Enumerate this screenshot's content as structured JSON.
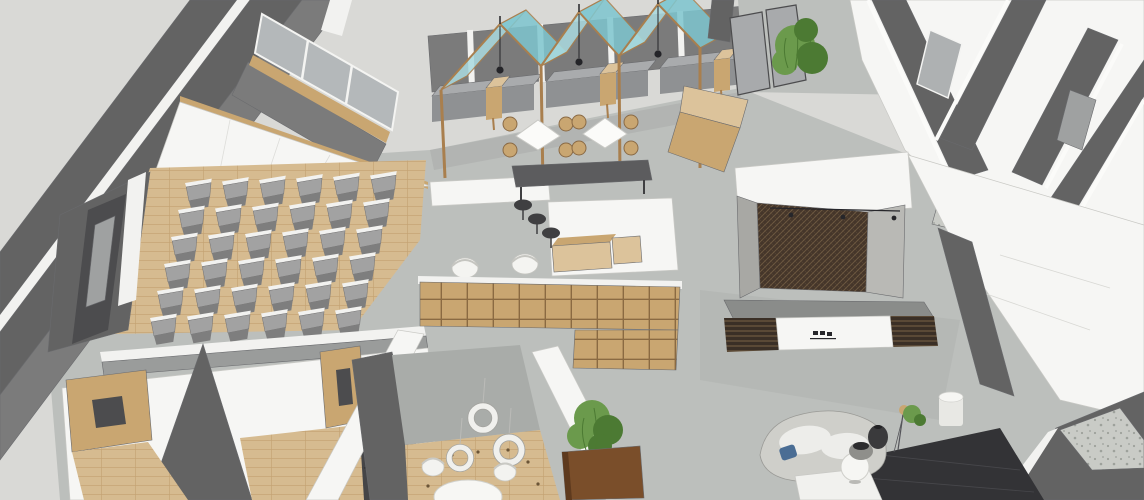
{
  "scene": {
    "type": "3d-interior-render",
    "description": "axonometric sketchup-style rendering of an open-plan office interior",
    "rooms": [
      {
        "id": "auditorium",
        "label": "auditorium-seating-room"
      },
      {
        "id": "cafe-booths",
        "label": "cafe-booth-seating-with-glass-canopies"
      },
      {
        "id": "library",
        "label": "library-bookshelf-room"
      },
      {
        "id": "meeting-room",
        "label": "small-meeting-room"
      },
      {
        "id": "reception",
        "label": "reception-with-mesh-feature-wall"
      },
      {
        "id": "lounge",
        "label": "lounge-seating-area"
      },
      {
        "id": "pantry",
        "label": "pantry-counter"
      },
      {
        "id": "offices",
        "label": "perimeter-offices-and-corridors"
      }
    ],
    "counts": {
      "canopy_modules": 3,
      "pendant_lights": 3,
      "ring_pendants": 3,
      "cafe_diamond_tables": 2,
      "rattan_chairs": 8,
      "bar_stools": 3,
      "booth_benches": 6,
      "booth_side_tables": 3,
      "plants": 3,
      "library_armchairs": 2,
      "meeting_chairs": 2
    }
  },
  "generator": {
    "auditorium_chairs": {
      "rows": 6,
      "cols": 6,
      "origin": [
        186,
        183
      ],
      "col_step": [
        37,
        -1.5
      ],
      "row_step": [
        -7,
        27
      ],
      "rotate": -3
    }
  },
  "palette": {
    "bg": "#d9d9d6",
    "wall_dark": "#636363",
    "wall_darker": "#4c4c4e",
    "wall_mid": "#7b7b7b",
    "wall_white": "#f6f6f4",
    "wall_white_shade": "#e6e6e3",
    "stripe_white": "#f2f2f0",
    "floor_concrete": "#bcbfbc",
    "floor_concrete_dark": "#a9aca9",
    "floor_wood": "#d6bb90",
    "plank_line": "#c2a171",
    "wood": "#c9a671",
    "wood_light": "#dcc39b",
    "wood_dark": "#a97f4e",
    "shelf_line": "#8a6a42",
    "glass_gray": "#b4b8ba",
    "glass_teal": "#7ec6cf",
    "glass_teal_light": "#aadbe0",
    "chair_gray": "#a2a2a2",
    "chair_gray_dark": "#7e7e7e",
    "bench_gray": "#a9abad",
    "bench_gray_dark": "#8f9193",
    "mesh_base": "#45362a",
    "mesh_line": "#6e5a41",
    "slat_base": "#3a2f26",
    "slat_line": "#6e5a41",
    "black": "#242428",
    "table_dark": "#5c5c5e",
    "stool_dark": "#3f3f41",
    "plant_green": "#6b9a4c",
    "plant_green_dark": "#4c7a33",
    "planter_brown": "#7a4e2a",
    "sofa_gray": "#cfcfca",
    "cushion_white": "#ededea",
    "pillow_blue": "#4a6d94",
    "rug_dark": "#333336",
    "terrazzo": "#c9cbc6",
    "terrazzo_dot": "#9da19b",
    "metal_gray": "#9fa1a1"
  }
}
